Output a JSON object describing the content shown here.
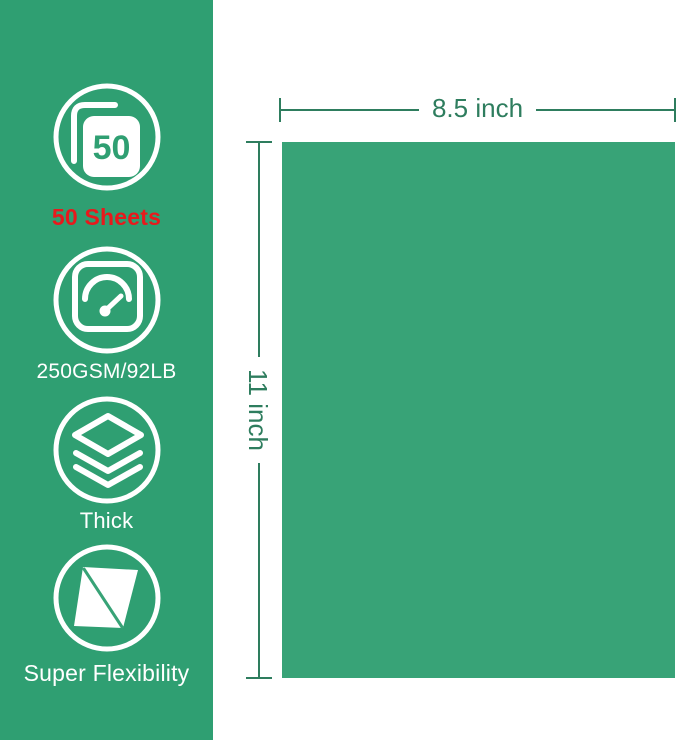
{
  "colors": {
    "banner_green": "#2f9f72",
    "paper_green": "#38a377",
    "dimension_green": "#2e7d5e",
    "highlight_red": "#e8191c",
    "white": "#ffffff"
  },
  "banner": {
    "features": [
      {
        "icon": "sheet-stack-50-icon",
        "badge": "50",
        "label": "50 Sheets"
      },
      {
        "icon": "gauge-icon",
        "label": "250GSM/92LB"
      },
      {
        "icon": "layers-thickness-icon",
        "label": "Thick"
      },
      {
        "icon": "flexible-sheet-icon",
        "label": "Super Flexibility"
      }
    ]
  },
  "paper": {
    "width_label": "8.5 inch",
    "height_label": "11 inch"
  }
}
